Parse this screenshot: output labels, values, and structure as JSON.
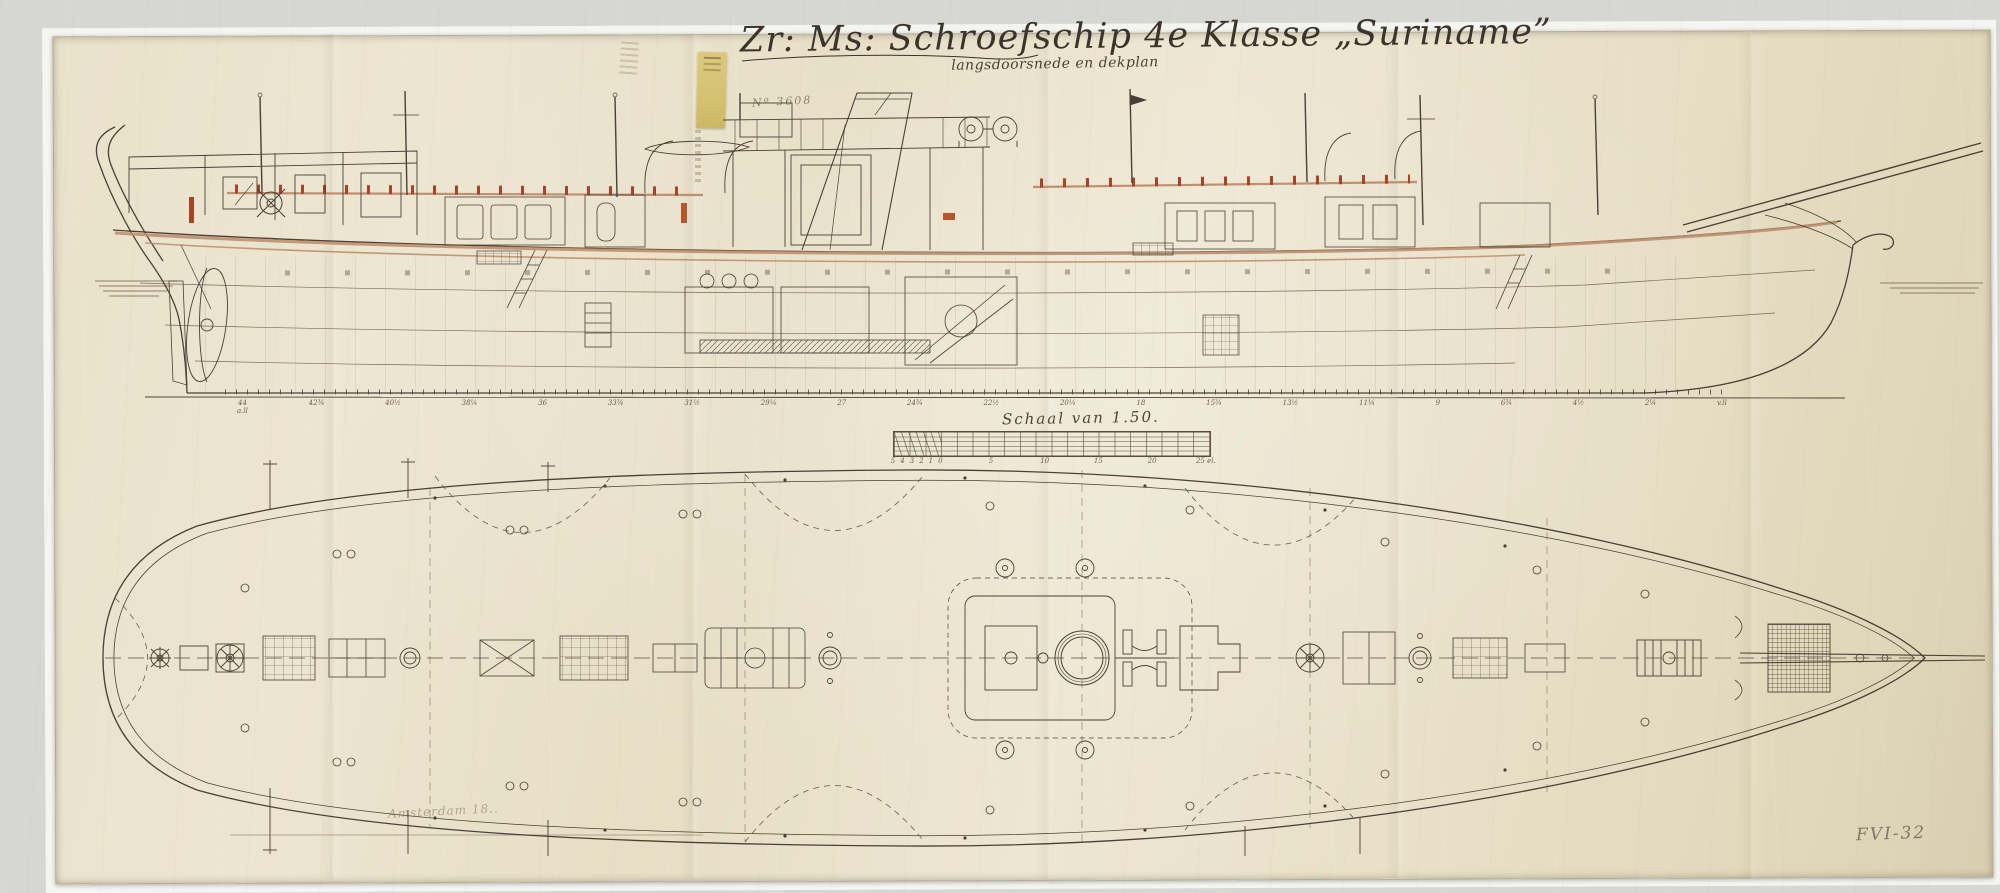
{
  "document": {
    "title": "Zr: Ms: Schroefschip 4e Klasse „Suriname”",
    "subtitle": "langsdoorsnede en dekplan",
    "drawing_number": "Nº 3608",
    "scale_caption": "Schaal van 1.50.",
    "inscription_bottom_left": "Amsterdam 18..",
    "inventory_mark": "FVI-32"
  },
  "elevation": {
    "description": "langsdoorsnede (longitudinal section), stern left with screw propeller, bow right with bowsprit",
    "station_labels": [
      "44\na.ll",
      "42¾",
      "40½",
      "38¼",
      "36",
      "33¾",
      "31½",
      "29¼",
      "27",
      "24¾",
      "22½",
      "20¼",
      "18",
      "15¾",
      "13½",
      "11¼",
      "9",
      "6¾",
      "4½",
      "2¼",
      "v.ll"
    ]
  },
  "scale_bar": {
    "unit": "el",
    "labels": [
      {
        "label": "5",
        "x": 0
      },
      {
        "label": "4",
        "x": 3
      },
      {
        "label": "3",
        "x": 6
      },
      {
        "label": "2",
        "x": 9
      },
      {
        "label": "1",
        "x": 12
      },
      {
        "label": "0",
        "x": 15
      },
      {
        "label": "5",
        "x": 31
      },
      {
        "label": "10",
        "x": 48
      },
      {
        "label": "15",
        "x": 65
      },
      {
        "label": "20",
        "x": 82
      },
      {
        "label": "25 el.",
        "x": 99
      }
    ]
  },
  "deckplan": {
    "description": "dekplan (deck plan), rounded stern left, pointed bow with bowsprit right, dashed centreline"
  },
  "colors": {
    "paper": "#ece5d0",
    "surround": "#d6d7d3",
    "ink_sepia": "#4a4036",
    "ink_light": "#8a7a64",
    "deck_tan": "#bf9070",
    "accent_red": "#a8432a",
    "sticker_yellow": "#d8c478",
    "pencil_gray": "#8d8578"
  }
}
